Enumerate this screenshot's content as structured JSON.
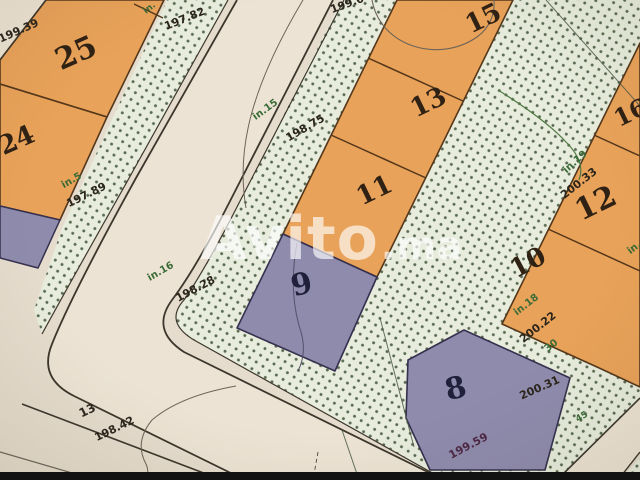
{
  "meta": {
    "kind": "scanned cadastral subdivision plan photo",
    "marketplace_watermark": "Avito.ma"
  },
  "watermark": {
    "brand": "Avito",
    "tld": ".ma"
  },
  "colors": {
    "paper": "#e5dccd",
    "road_surface": "#ece3d4",
    "green_space_dots": "#46583f",
    "green_space_bg": "#e7ecdc",
    "parcel_orange": "#e9a259",
    "parcel_purple": "#8f8bad",
    "boundary_dark": "#3c362c",
    "green_text": "#3a6b36",
    "watermark_white": "#ffffff",
    "bottom_bar_black": "#121212"
  },
  "labels": {
    "p25": "25",
    "p24": "24",
    "p15": "15",
    "p13": "13",
    "p11": "11",
    "p16": "16",
    "p12": "12",
    "p10": "10",
    "p9": "9",
    "p8": "8",
    "e199_39": "199.39",
    "e197_82": "197.82",
    "e199_04": "199.04",
    "e198_75": "198.75",
    "e197_89": "197.89",
    "e198_28": "198.28",
    "e198_42": "198.42",
    "e199_59": "199.59",
    "e200_33": "200.33",
    "e200_22": "200.22",
    "e200_31": "200.31",
    "g_in_top": "in.",
    "g_in15": "in.15",
    "g_in5": "in.5",
    "g_in16": "in.16",
    "g_in18": "in.18",
    "g_in19": "in.19",
    "g_in_right": "in.",
    "g_30": "30",
    "g_45": "45",
    "pt13": "13"
  }
}
